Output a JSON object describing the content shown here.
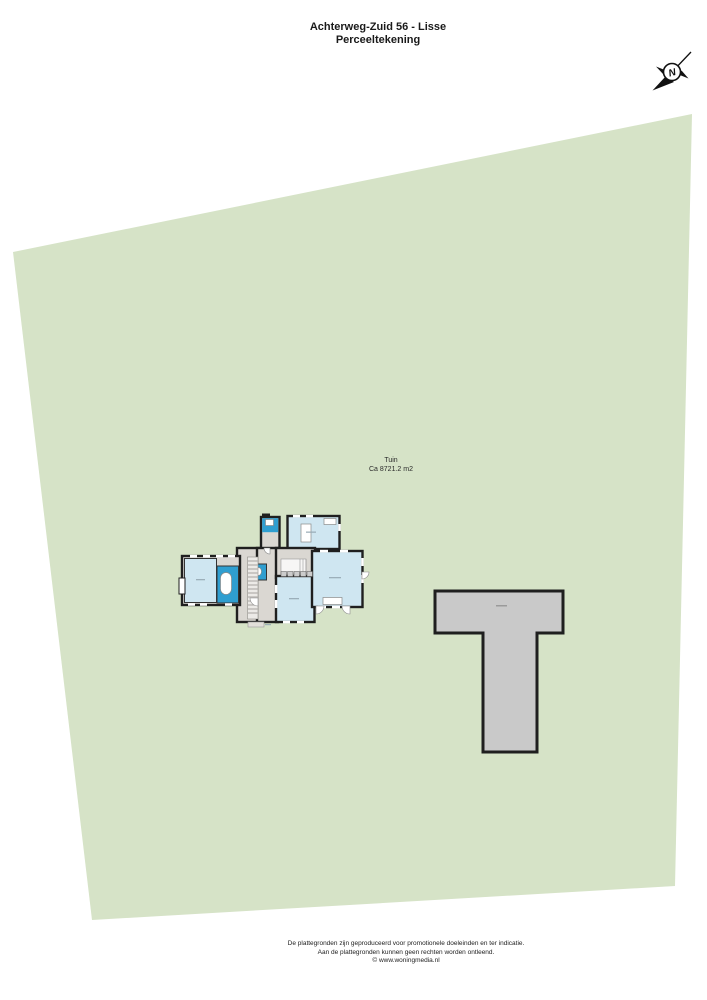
{
  "title": {
    "line1": "Achterweg-Zuid 56 - Lisse",
    "line2": "Perceeltekening"
  },
  "compass": {
    "label": "N"
  },
  "garden": {
    "name": "Tuin",
    "area": "Ca 8721.2 m2"
  },
  "footer": {
    "line1": "De plattegronden zijn geproduceerd voor promotionele doeleinden en ter indicatie.",
    "line2": "Aan de plattegronden kunnen geen rechten worden ontleend.",
    "line3": "© www.woningmedia.nl"
  },
  "colors": {
    "plot_green": "#d6e3c7",
    "outbuilding_gray": "#c9c9c9",
    "room_blue": "#cfe6f1",
    "bath_blue": "#2f9ed0",
    "hall_gray": "#dad7d2",
    "wall_black": "#1f1f1f",
    "page_white": "#ffffff"
  }
}
